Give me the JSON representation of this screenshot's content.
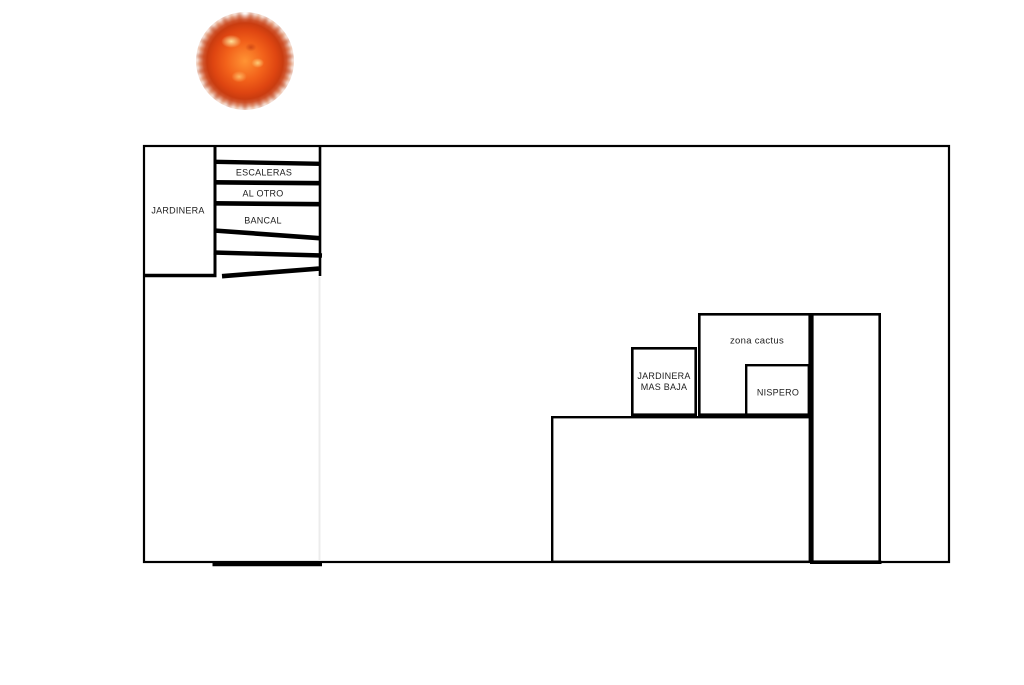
{
  "canvas": {
    "background": "#ffffff",
    "ink_color": "#000000",
    "faint_line_color": "#ececec",
    "text_color": "#1d1d1d"
  },
  "sun": {
    "name": "sun photo",
    "core_color": "#e8481c",
    "highlight_color": "#ffd27a",
    "ray_color": "#cf6236"
  },
  "plan": {
    "left_planter": {
      "label": "JARDINERA"
    },
    "stairs": {
      "label_lines": [
        "ESCALERAS",
        "AL OTRO",
        "BANCAL"
      ]
    },
    "cactus_zone": {
      "label": "zona cactus"
    },
    "lower_planter": {
      "label_lines": [
        "JARDINERA",
        "MAS BAJA"
      ]
    },
    "loquat_tree": {
      "label": "NISPERO"
    }
  }
}
